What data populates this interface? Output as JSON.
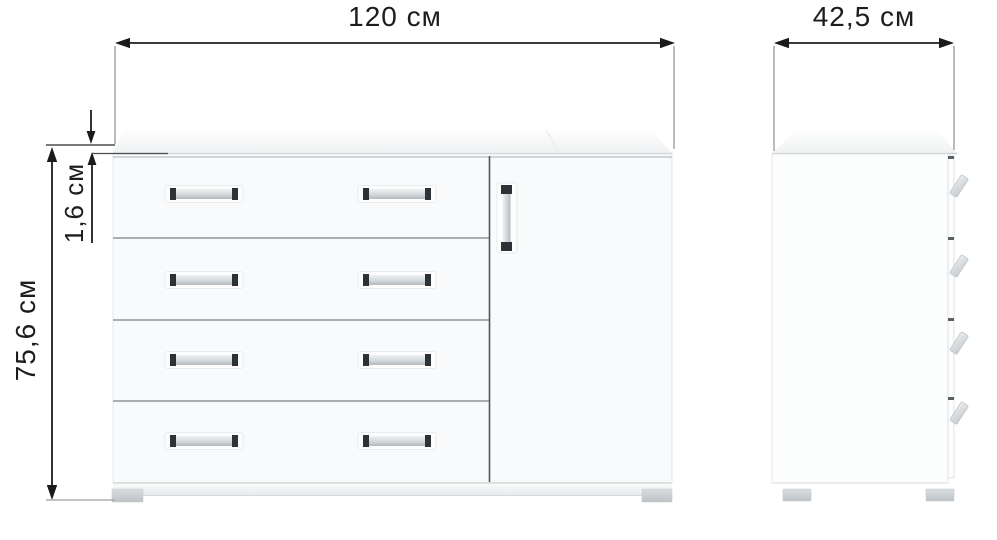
{
  "dimensions": {
    "width": {
      "label": "120 см",
      "value_cm": 120
    },
    "depth": {
      "label": "42,5 см",
      "value_cm": 42.5
    },
    "height": {
      "label": "75,6 см",
      "value_cm": 75.6
    },
    "top_panel_thickness": {
      "label": "1,6 см",
      "value_cm": 1.6
    }
  },
  "views": {
    "front": {
      "drawer_count": 4,
      "door_count": 1,
      "handles_per_drawer": 2
    },
    "side": {
      "drawer_edge_count": 4
    }
  },
  "colors": {
    "background": "#ffffff",
    "dimension_line": "#1b1b1b",
    "extension_line": "#8a8e92",
    "panel_divider": "#8f959a",
    "door_divider": "#51565b",
    "handle_cap": "#2d3237",
    "handle_bar": "#c3c9cd",
    "foot": "#c9ced2"
  }
}
